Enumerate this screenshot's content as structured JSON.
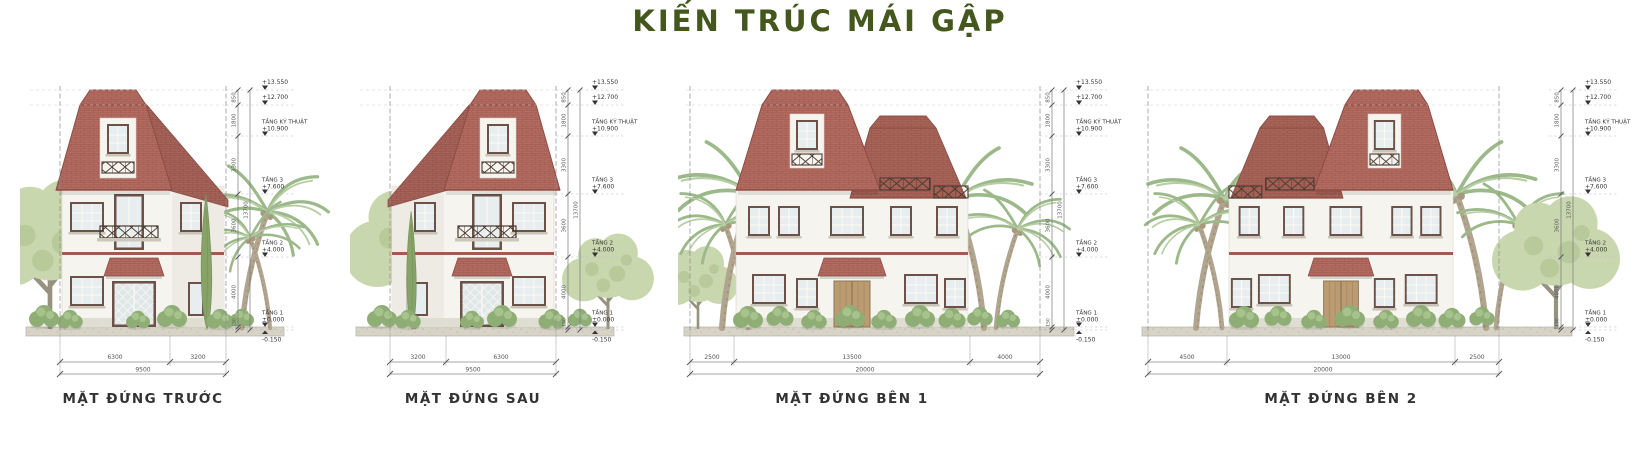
{
  "title": "KIẾN TRÚC MÁI GẬP",
  "levels": {
    "l1_value": "+13.550",
    "l2_value": "+12.700",
    "l3_label": "TẦNG KỸ THUẬT",
    "l3_value": "+10.900",
    "l4_label": "TẦNG 3",
    "l4_value": "+7.600",
    "l5_label": "TẦNG 2",
    "l5_value": "+4.000",
    "l6_label": "TẦNG 1",
    "l6_value": "±0.000",
    "l7_value": "-0.150"
  },
  "vertical_dims": {
    "segments": [
      "850",
      "1800",
      "3300",
      "3600",
      "4000",
      "150"
    ],
    "total": "13700"
  },
  "views": [
    {
      "label": "MẶT ĐỨNG TRƯỚC",
      "dims": [
        "6300",
        "3200"
      ],
      "total": "9500"
    },
    {
      "label": "MẶT ĐỨNG SAU",
      "dims": [
        "3200",
        "6300"
      ],
      "total": "9500"
    },
    {
      "label": "MẶT ĐỨNG BÊN 1",
      "dims": [
        "2500",
        "13500",
        "4000"
      ],
      "total": "20000"
    },
    {
      "label": "MẶT ĐỨNG BÊN 2",
      "dims": [
        "4500",
        "13000",
        "2500"
      ],
      "total": "20000"
    }
  ],
  "colors": {
    "title_green": "#44581d",
    "roof_terracotta": "#b36c61",
    "wall_cream": "#f6f4ef",
    "foliage_green": "#c9d7af"
  }
}
